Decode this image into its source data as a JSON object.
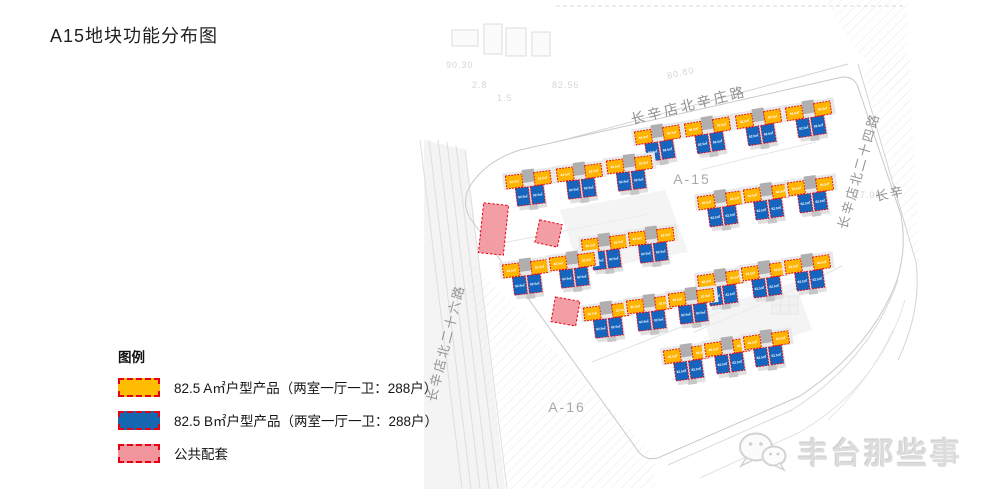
{
  "title": "A15地块功能分布图",
  "legend": {
    "heading": "图例",
    "items": [
      {
        "name": "type-a-product",
        "color": "#FFBC00",
        "border": "#E60012",
        "label": "82.5 A㎡户型产品（两室一厅一卫：288户）"
      },
      {
        "name": "type-b-product",
        "color": "#1667B1",
        "border": "#E60012",
        "label": "82.5 B㎡户型产品（两室一厅一卫：288户）"
      },
      {
        "name": "public-facility",
        "color": "#F2949B",
        "border": "#E60012",
        "label": "公共配套"
      }
    ]
  },
  "map": {
    "roads": {
      "north": "长辛店北辛庄路",
      "east": "长辛店北二十四路",
      "west": "长辛店北二十六路",
      "east_partial": "长辛"
    },
    "plots": {
      "a15": "A-15",
      "a16": "A-16"
    },
    "unit_label": "82.5㎡",
    "colors": {
      "type_a": "#FFB400",
      "type_b": "#1565BE",
      "public": "#F2949B",
      "outline": "#E60012",
      "core": "#AFAFAF"
    },
    "clusters": [
      {
        "x": 634,
        "y": 130,
        "rot": -9
      },
      {
        "x": 684,
        "y": 122,
        "rot": -9
      },
      {
        "x": 735,
        "y": 114,
        "rot": -9
      },
      {
        "x": 785,
        "y": 106,
        "rot": -9
      },
      {
        "x": 505,
        "y": 174,
        "rot": -7
      },
      {
        "x": 556,
        "y": 167,
        "rot": -7
      },
      {
        "x": 606,
        "y": 159,
        "rot": -7
      },
      {
        "x": 697,
        "y": 195,
        "rot": -8
      },
      {
        "x": 743,
        "y": 188,
        "rot": -8
      },
      {
        "x": 787,
        "y": 181,
        "rot": -8
      },
      {
        "x": 581,
        "y": 238,
        "rot": -7
      },
      {
        "x": 628,
        "y": 231,
        "rot": -7
      },
      {
        "x": 502,
        "y": 263,
        "rot": -7
      },
      {
        "x": 549,
        "y": 256,
        "rot": -7
      },
      {
        "x": 697,
        "y": 274,
        "rot": -8
      },
      {
        "x": 741,
        "y": 266,
        "rot": -8
      },
      {
        "x": 784,
        "y": 259,
        "rot": -8
      },
      {
        "x": 583,
        "y": 306,
        "rot": -7
      },
      {
        "x": 626,
        "y": 299,
        "rot": -7
      },
      {
        "x": 668,
        "y": 292,
        "rot": -7
      },
      {
        "x": 663,
        "y": 349,
        "rot": -8
      },
      {
        "x": 704,
        "y": 342,
        "rot": -8
      },
      {
        "x": 743,
        "y": 335,
        "rot": -8
      }
    ],
    "facilities": [
      {
        "x": 481,
        "y": 204,
        "w": 25,
        "h": 50,
        "rot": 6
      },
      {
        "x": 537,
        "y": 222,
        "w": 23,
        "h": 23,
        "rot": 12
      },
      {
        "x": 553,
        "y": 299,
        "w": 25,
        "h": 25,
        "rot": 10
      }
    ],
    "faint_labels": [
      {
        "text": "90.30",
        "x": 446,
        "y": 68,
        "rot": 0
      },
      {
        "text": "2.8",
        "x": 472,
        "y": 88,
        "rot": 0
      },
      {
        "text": "82.56",
        "x": 552,
        "y": 88,
        "rot": 0
      },
      {
        "text": "1.5",
        "x": 497,
        "y": 101,
        "rot": 0
      },
      {
        "text": "80.80",
        "x": 668,
        "y": 79,
        "rot": -13
      },
      {
        "text": "27.08",
        "x": 854,
        "y": 198,
        "rot": 0
      }
    ]
  },
  "watermark": {
    "text": "丰台那些事"
  }
}
